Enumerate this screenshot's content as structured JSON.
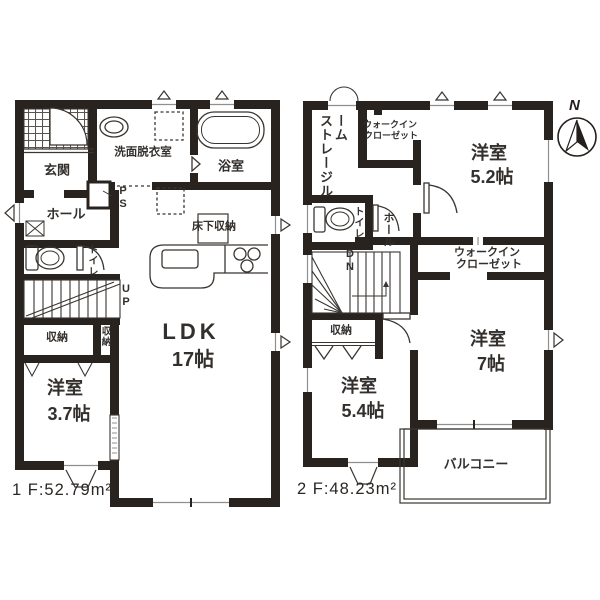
{
  "floor1": {
    "area_label": "1 F:52.79m²",
    "labels": {
      "genkan": "玄関",
      "washroom": "洗面脱衣室",
      "bathroom": "浴室",
      "hall": "ホール",
      "toilet": "トイレ",
      "pipe_space": "PS",
      "underfloor_storage": "床下収納",
      "ldk_name": "LDK",
      "ldk_size": "17帖",
      "stairs_up": "UP",
      "closet_main": "収納",
      "closet_side": "収納",
      "west_room_name": "洋室",
      "west_room_size": "3.7帖"
    }
  },
  "floor2": {
    "area_label": "2 F:48.23m²",
    "labels": {
      "storage_room": "ストレージルーム",
      "wic_top_line1": "ウォークイン",
      "wic_top_line2": "クローゼット",
      "room52_name": "洋室",
      "room52_size": "5.2帖",
      "toilet": "トイレ",
      "hall": "ホール",
      "stairs_down": "DN",
      "closet": "収納",
      "wic_mid_line1": "ウォークイン",
      "wic_mid_line2": "クローゼット",
      "room7_name": "洋室",
      "room7_size": "7帖",
      "room54_name": "洋室",
      "room54_size": "5.4帖",
      "balcony": "バルコニー"
    }
  },
  "compass": {
    "north": "N"
  },
  "colors": {
    "wall": "#29231f",
    "line": "#3a3531",
    "text": "#332f2c",
    "window": "#8f8f8f",
    "background": "#ffffff"
  }
}
